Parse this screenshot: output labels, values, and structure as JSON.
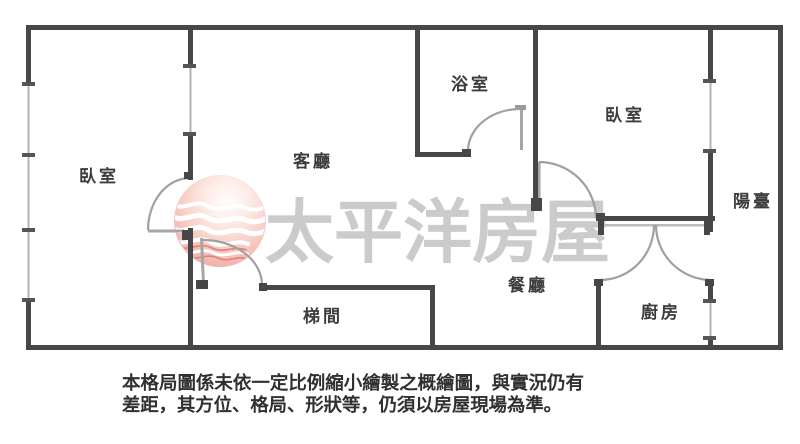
{
  "floor_plan": {
    "rooms": [
      {
        "id": "bedroom-left",
        "label": "臥室"
      },
      {
        "id": "living-room",
        "label": "客廳"
      },
      {
        "id": "bathroom",
        "label": "浴室"
      },
      {
        "id": "bedroom-right",
        "label": "臥室"
      },
      {
        "id": "balcony",
        "label": "陽臺"
      },
      {
        "id": "dining-room",
        "label": "餐廳"
      },
      {
        "id": "kitchen",
        "label": "廚房"
      },
      {
        "id": "stairwell",
        "label": "梯間"
      }
    ],
    "watermark": {
      "text": "太平洋房屋",
      "logo": "pacific-house-sphere-logo"
    },
    "disclaimer": {
      "line1": "本格局圖係未依一定比例縮小繪製之概繪圖，與實況仍有",
      "line2": "差距，其方位、格局、形狀等，仍須以房屋現場為準。"
    },
    "colors": {
      "wall": "#474747",
      "window": "#b3b3b3",
      "door_arc": "#a0a0a0",
      "label": "#3c3c3c",
      "watermark_text": "#c4c4c4",
      "logo_pink": "#f2b6af"
    }
  }
}
